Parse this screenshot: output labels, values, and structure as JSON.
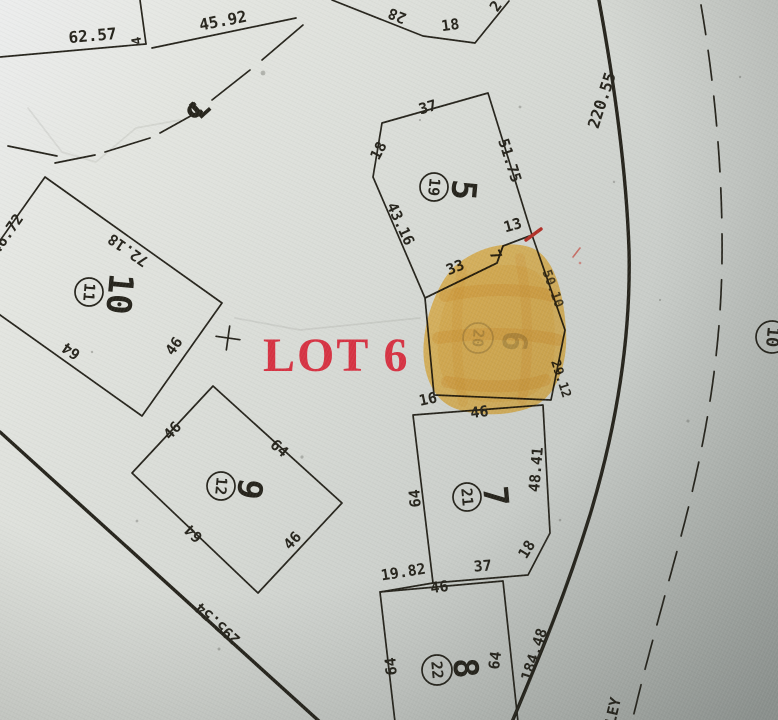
{
  "annotation": {
    "lot_label": "LOT 6",
    "street_name_partial": "LEY"
  },
  "symbols": {
    "centerline": "℄",
    "plus_cross": "+",
    "corner_tick": "4"
  },
  "colors": {
    "ink": "#26241c",
    "annotation_red": "#d63343",
    "highlight_orange": "#ffb31a",
    "tick_red": "#b03028",
    "paper_light": "#eceded",
    "paper_dark": "#a7adaa"
  },
  "boundaries": {
    "dim_62_57": "62.57",
    "dim_45_92": "45.92",
    "dim_28": "28",
    "dim_18_top": "18",
    "dim_2_partial": "2",
    "road_dim_220_55": "220.55",
    "road_dim_184_48": "184.48",
    "road_dim_295_54": "295.54"
  },
  "lots": {
    "lot5": {
      "circled": "19",
      "number": "5",
      "dim_top": "37",
      "dim_upper_left": "18",
      "dim_left": "43.16",
      "dim_right": "51.75"
    },
    "lot6": {
      "circled": "20",
      "number": "6",
      "dim_13": "13",
      "dim_7": "7",
      "dim_33": "33",
      "dim_right_upper": "50.10",
      "dim_right_lower": "29.12"
    },
    "lot7": {
      "circled": "21",
      "number": "7",
      "dim_16": "16",
      "dim_top": "46",
      "dim_left": "64",
      "dim_right": "48.41",
      "dim_lower_right": "18",
      "dim_bottom": "37",
      "dim_19_82": "19.82"
    },
    "lot8": {
      "circled": "22",
      "number": "8",
      "dim_top": "46",
      "dim_left": "64",
      "dim_right": "64"
    },
    "lot9": {
      "circled": "12",
      "number": "9",
      "dim_top_left": "46",
      "dim_top_right": "64",
      "dim_bottom_left": "64",
      "dim_bottom_right": "46"
    },
    "lot10": {
      "circled": "11",
      "number": "10",
      "dim_top": "72.18",
      "dim_right": "46",
      "dim_bottom": "64",
      "dim_left_outer": "46.72"
    },
    "lot_right_edge": {
      "circled": "10"
    }
  }
}
